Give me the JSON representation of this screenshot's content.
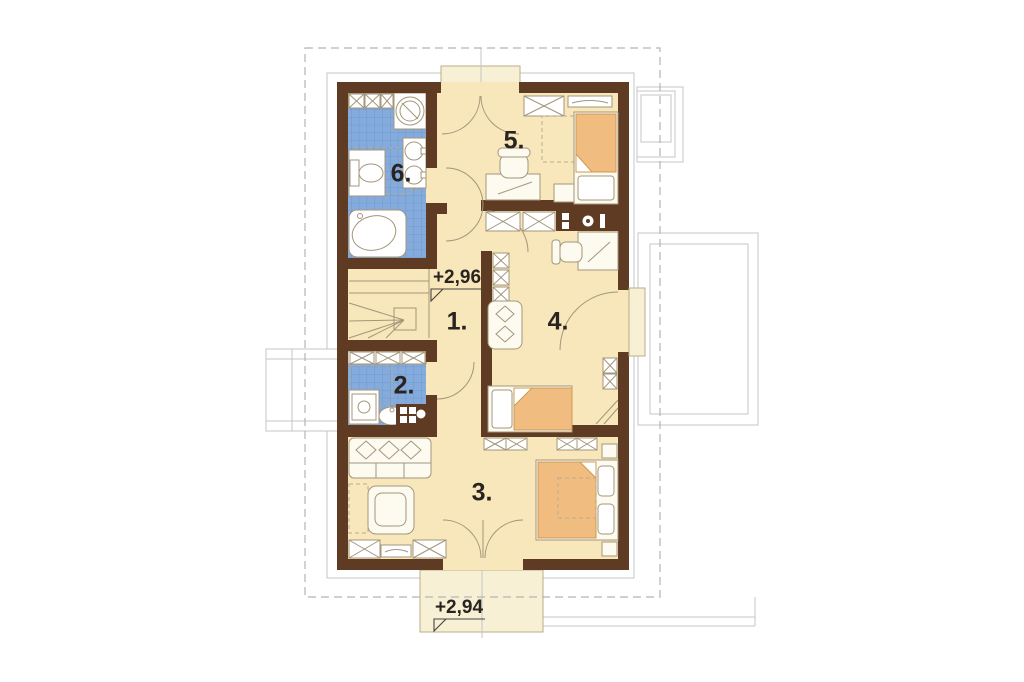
{
  "plan": {
    "figure_type": "floor-plan",
    "rooms": [
      {
        "id": "1",
        "label": "1."
      },
      {
        "id": "2",
        "label": "2."
      },
      {
        "id": "3",
        "label": "3."
      },
      {
        "id": "4",
        "label": "4."
      },
      {
        "id": "5",
        "label": "5."
      },
      {
        "id": "6",
        "label": "6."
      }
    ],
    "levels": [
      {
        "label": "+2,96"
      },
      {
        "label": "+2,94"
      }
    ],
    "colors": {
      "wall": "#5e3b22",
      "floor": "#f8e7ba",
      "tile": "#84abdb",
      "tile_grid": "#6e99cf",
      "accent_orange": "#f1bc80",
      "outline": "#a3967b"
    }
  }
}
